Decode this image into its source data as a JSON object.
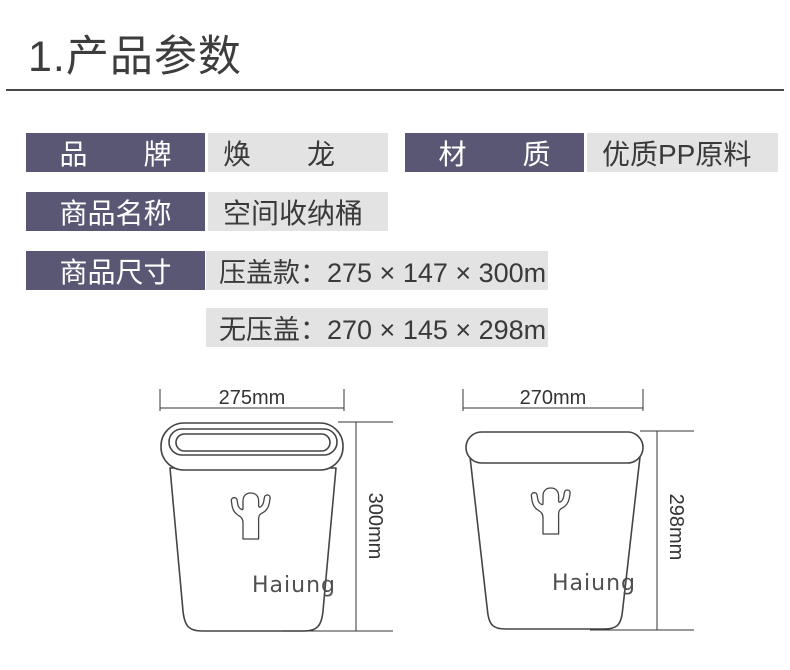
{
  "page": {
    "title": "1.产品参数"
  },
  "specs": {
    "brand_label": "品　　牌",
    "brand_value": "焕　　龙",
    "material_label": "材　　质",
    "material_value": "优质PP原料",
    "name_label": "商品名称",
    "name_value": "空间收纳桶",
    "size_label": "商品尺寸",
    "size_value_lidded": "压盖款：275 × 147 × 300mm",
    "size_value_open": "无压盖：270 × 145 × 298mm"
  },
  "diagram": {
    "left_bin": {
      "width_label": "275mm",
      "height_label": "300mm",
      "brand": "Haiung"
    },
    "right_bin": {
      "width_label": "270mm",
      "height_label": "298mm",
      "brand": "Haiung"
    }
  },
  "colors": {
    "label_bg": "#5a5774",
    "value_bg": "#e3e3e3",
    "line": "#454545",
    "text": "#3a3a3a"
  }
}
